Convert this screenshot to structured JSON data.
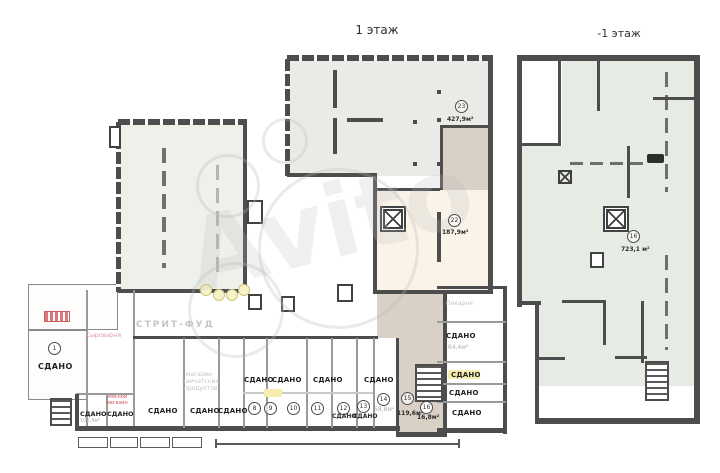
{
  "watermark": {
    "text": "Avito"
  },
  "floor1": {
    "title": "1 этаж",
    "labels": {
      "rented": "СДАНО",
      "street_food": "СТРИТ-ФУД",
      "bakery": "Пекарня",
      "cheese_shop": "Сыроварня",
      "kamchatka_line1": "магазин",
      "kamchatka_line2": "камчатских",
      "kamchatka_line3": "продуктов",
      "meat_line1": "мясной",
      "meat_line2": "магазин"
    },
    "areas": {
      "shop_left": "100,4м²",
      "near_bakery": "64,4м²"
    },
    "rooms": {
      "r1": {
        "number": "1"
      },
      "r8": {
        "number": "8"
      },
      "r9": {
        "number": "9"
      },
      "r10": {
        "number": "10"
      },
      "r11": {
        "number": "11"
      },
      "r12": {
        "number": "12"
      },
      "r13": {
        "number": "13"
      },
      "r14": {
        "number": "14",
        "area": "58,8м²"
      },
      "r15": {
        "number": "15",
        "area": "119,6м²"
      },
      "r16": {
        "number": "16",
        "area": "16,8м²"
      },
      "r22": {
        "number": "22",
        "area": "187,9м²"
      },
      "r23": {
        "number": "23",
        "area": "427,9м²"
      }
    }
  },
  "floor_minus1": {
    "title": "-1 этаж",
    "rooms": {
      "r16": {
        "number": "16",
        "area": "723,1 м²"
      }
    }
  },
  "colors": {
    "wall": "#4d4d4d",
    "room23_fill": "#e9ece6",
    "room22_fill": "#faf4e8",
    "corridor_fill": "#d9d0c6",
    "hall_fill": "#eef0ea",
    "basement_fill": "#e6ebe4",
    "highlight": "#f5edae"
  }
}
